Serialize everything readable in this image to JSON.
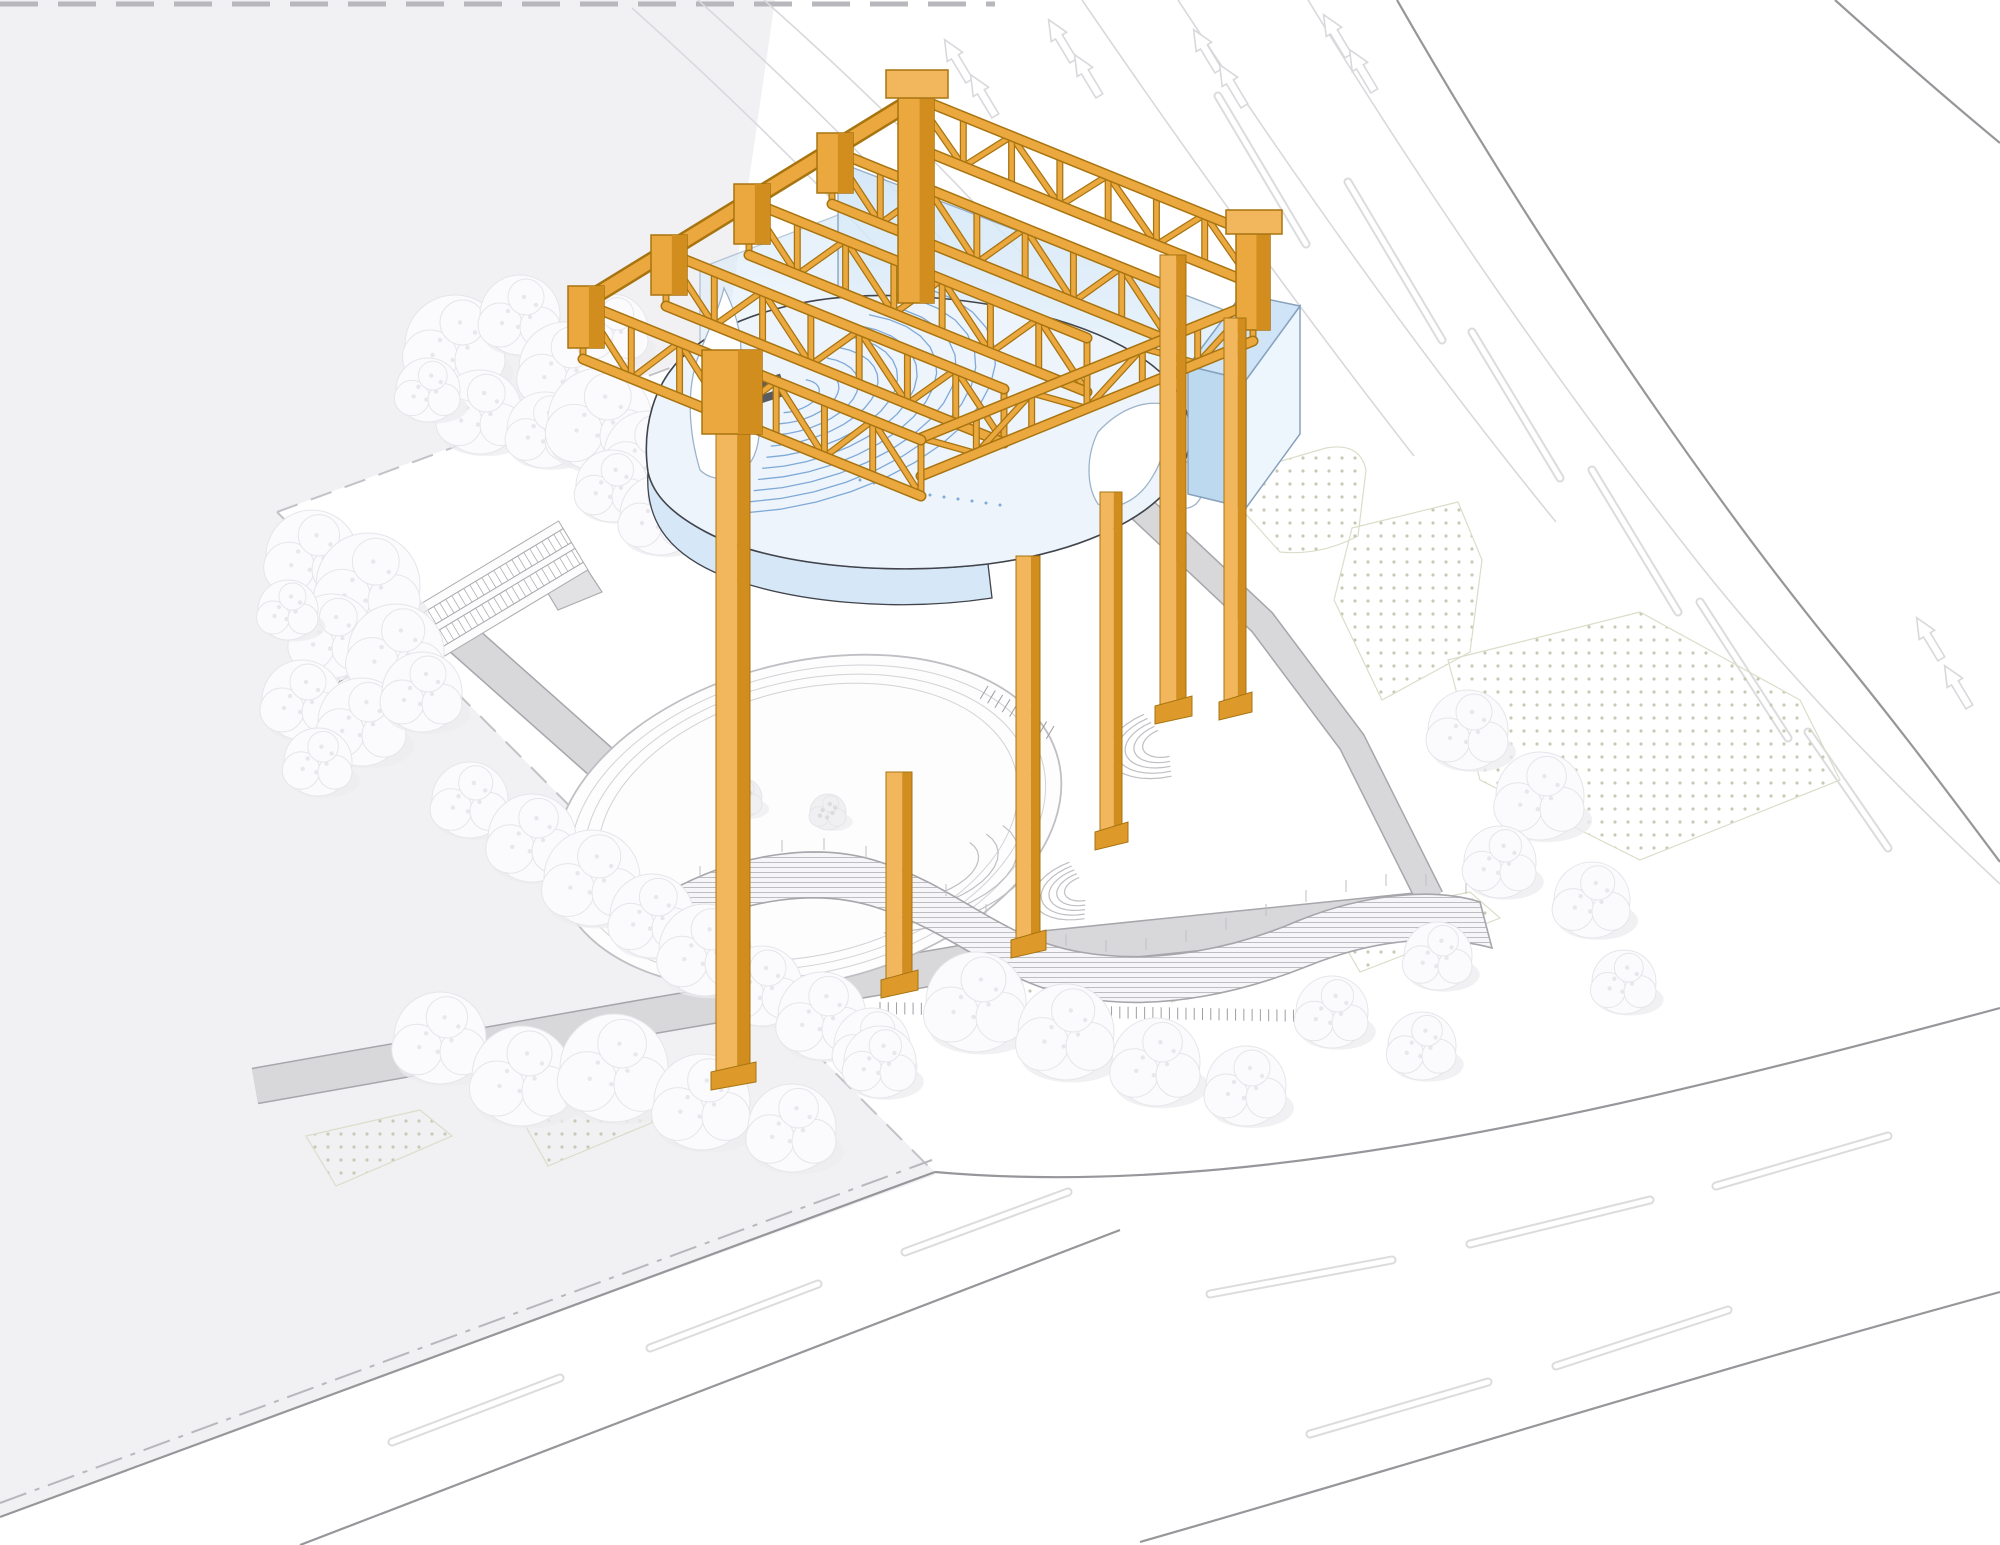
{
  "title": "Axonometric site diagram — orange gantry structure over theater site",
  "palette": {
    "background": "#ffffff",
    "gray_field": "#f1f1f4",
    "road_edge": "#97979b",
    "road_light": "#d9d9dd",
    "lane_outline": "#dcdcdf",
    "lane_core": "#ffffff",
    "boundary_dash": "#c2c2c7",
    "dashdot": "#b7b7bc",
    "path_fill": "#d8d8db",
    "path_edge": "#a6a6ab",
    "dot_fill": "#c9c9b6",
    "dot_edge": "#dcdcca",
    "tree_fill": "#fbfbfd",
    "tree_edge": "#e6e6ea",
    "tree_shadow": "#ececef",
    "tree_speckle": "#e8e8ec",
    "tree_muted": "#f0f0f2",
    "tree_muted_speckle": "#dcdcdf",
    "orange": "#EAA83F",
    "orange_light": "#F2B75C",
    "orange_dark": "#D18D1E",
    "orange_outline": "#A87410",
    "orange_foot": "#DD9A2B",
    "glass_light": "#eef6fd",
    "glass_mid": "#cfe5f7",
    "glass_deep": "#bcd9f0",
    "glass_edge": "#87a2bd",
    "amph_fill": "#edf4fb",
    "amph_line": "#7fa9d8",
    "amph_outline": "#41444b",
    "amph_rim": "#d6e7f7",
    "pylon_fill": "#ffffff",
    "pylon_edge": "#9db3c9",
    "stage_dark": "#5a5b60",
    "court_line": "#bfbfc4",
    "court_line_light": "#d2d2d7",
    "louver_line": "#bdbdc3",
    "louver_bg": "#f6f6f8",
    "hatch": "#9e9ea3",
    "wall_fill": "#e2e2e5",
    "wall_edge": "#ababb0"
  },
  "scene": {
    "grayField": [
      [
        0,
        0
      ],
      [
        775,
        0
      ],
      [
        700,
        520
      ],
      [
        935,
        1175
      ],
      [
        43,
        1500
      ],
      [
        0,
        1517
      ]
    ],
    "siteDiamond": [
      [
        277,
        512
      ],
      [
        727,
        345
      ],
      [
        1300,
        520
      ],
      [
        1240,
        1010
      ],
      [
        935,
        1172
      ]
    ],
    "boundaryDashes": [
      [
        277,
        512,
        727,
        347
      ],
      [
        277,
        512,
        930,
        1168
      ]
    ],
    "topDash": [
      0,
      4,
      995,
      4
    ],
    "dashDot": [
      0,
      1503,
      932,
      1160
    ],
    "roadEdges": [
      "M 0,1517 L 935,1172",
      "M 300,1545 L 1120,1230",
      "M 935,1172 C 1250,1200 1620,1110 2000,1008",
      "M 1140,1542 C 1420,1462 1720,1368 2000,1292",
      "M 1397,0 C 1520,215 1690,470 1832,645 C 1900,728 1952,798 2000,862",
      "M 1835,0 C 1893,52 1948,100 2000,143"
    ],
    "roadLight": [
      "M 1308,0 C 1428,196 1562,390 1700,565 C 1800,690 1902,792 2000,884",
      "M 1178,0 C 1296,180 1424,360 1556,522",
      "M 1082,0 C 1190,158 1300,310 1414,456",
      "M 632,8 C 726,92 820,184 912,284",
      "M 698,0 C 790,82 880,172 968,268",
      "M 764,0 C 852,78 938,162 1020,252"
    ],
    "laneDashes": [
      [
        392,
        1442,
        560,
        1378
      ],
      [
        650,
        1348,
        818,
        1284
      ],
      [
        905,
        1252,
        1068,
        1192
      ],
      [
        1210,
        1294,
        1392,
        1260
      ],
      [
        1470,
        1244,
        1650,
        1200
      ],
      [
        1716,
        1186,
        1888,
        1136
      ],
      [
        1310,
        1434,
        1488,
        1382
      ],
      [
        1556,
        1366,
        1728,
        1310
      ],
      [
        1218,
        96,
        1306,
        244
      ],
      [
        1348,
        182,
        1442,
        340
      ],
      [
        1472,
        332,
        1560,
        478
      ],
      [
        1592,
        470,
        1678,
        612
      ],
      [
        1700,
        602,
        1788,
        738
      ],
      [
        1808,
        732,
        1888,
        848
      ]
    ],
    "arrows": {
      "positions": [
        [
          958,
          62
        ],
        [
          984,
          97
        ],
        [
          1062,
          42
        ],
        [
          1088,
          77
        ],
        [
          1207,
          52
        ],
        [
          1233,
          87
        ],
        [
          1337,
          37
        ],
        [
          1363,
          72
        ],
        [
          1930,
          640
        ],
        [
          1958,
          688
        ]
      ],
      "rotation": -31
    },
    "dotRegions": [
      "M 1250,470 L 1326,448 Q 1360,442 1366,470 L 1358,536 Q 1320,556 1280,552 L 1244,512 Z",
      "M 1352,528 L 1458,502 L 1482,560 L 1470,652 L 1382,700 L 1334,600 Z",
      "M 1448,660 L 1640,612 L 1800,700 L 1840,780 L 1640,860 L 1480,780 Z",
      "M 306,1136 L 420,1110 L 452,1136 L 336,1186 Z",
      "M 520,1116 L 640,1090 L 668,1116 L 548,1166 Z",
      "M 952,978 L 1088,950 L 1126,976 L 990,1036 Z",
      "M 1140,950 L 1286,922 L 1318,948 L 1172,1002 Z",
      "M 1330,920 L 1470,892 L 1500,918 L 1360,972 Z"
    ],
    "walkways": [
      {
        "pts": [
          [
            450,
            628
          ],
          [
            700,
            850
          ],
          [
            746,
            872
          ]
        ],
        "w": 34
      },
      {
        "pts": [
          [
            255,
            1086
          ],
          [
            640,
            1018
          ],
          [
            1050,
            948
          ],
          [
            1442,
            908
          ]
        ],
        "w": 34
      },
      {
        "pts": [
          [
            1128,
            496
          ],
          [
            1262,
            622
          ],
          [
            1352,
            742
          ],
          [
            1430,
            898
          ]
        ],
        "w": 26
      }
    ],
    "landing": [
      [
        706,
        838
      ],
      [
        798,
        870
      ],
      [
        760,
        938
      ],
      [
        668,
        902
      ]
    ],
    "sideWall": [
      [
        528,
        560
      ],
      [
        570,
        543
      ],
      [
        602,
        592
      ],
      [
        558,
        610
      ]
    ],
    "escalator": {
      "x": 573,
      "y": 545,
      "angle": 59,
      "len": 300
    },
    "court": {
      "cx": 808,
      "cy": 822,
      "rx": 258,
      "ry": 160,
      "rot": -14,
      "rings": [
        0,
        -16,
        -30,
        -44
      ]
    },
    "benchArcs": [
      {
        "cx": 1168,
        "cy": 742,
        "r0": 26,
        "step": 9,
        "n": 5,
        "a0": 95,
        "a1": 255,
        "sq": 0.55,
        "rot": -15
      },
      {
        "cx": 1086,
        "cy": 888,
        "r0": 22,
        "step": 8,
        "n": 5,
        "a0": 100,
        "a1": 260,
        "sq": 0.55,
        "rot": -15
      },
      {
        "cx": 920,
        "cy": 868,
        "r0": 60,
        "step": 20,
        "n": 4,
        "a0": -25,
        "a1": 115,
        "sq": 0.5,
        "rot": -14
      }
    ],
    "stairComb": {
      "x1": 988,
      "y1": 686,
      "x2": 1054,
      "y2": 726,
      "n": 9,
      "len": 15
    },
    "louverBuilding": {
      "body": "M 668,892 C 740,852 820,842 880,862 C 960,888 1000,938 1080,952 C 1160,966 1240,946 1300,920 C 1360,896 1430,886 1480,902 L 1492,948 C 1432,932 1368,942 1308,966 C 1248,990 1165,1012 1082,998 C 1000,984 958,934 878,908 C 818,888 742,898 676,936 Z",
      "railTicks": [
        [
          700,
          878
        ],
        [
          740,
          862
        ],
        [
          782,
          852
        ],
        [
          824,
          850
        ],
        [
          866,
          858
        ],
        [
          906,
          874
        ],
        [
          946,
          896
        ],
        [
          986,
          916
        ],
        [
          1026,
          934
        ],
        [
          1066,
          946
        ],
        [
          1106,
          952
        ],
        [
          1146,
          950
        ],
        [
          1186,
          942
        ],
        [
          1226,
          930
        ],
        [
          1266,
          916
        ],
        [
          1306,
          902
        ],
        [
          1346,
          892
        ],
        [
          1386,
          886
        ],
        [
          1426,
          886
        ],
        [
          1466,
          894
        ]
      ],
      "combBase": [
        880,
        1002,
        1310,
        1010
      ],
      "combN": 52
    },
    "trees": [
      [
        455,
        345,
        50
      ],
      [
        520,
        315,
        40
      ],
      [
        565,
        368,
        46
      ],
      [
        612,
        330,
        36
      ],
      [
        480,
        412,
        42
      ],
      [
        545,
        430,
        38
      ],
      [
        428,
        390,
        32
      ],
      [
        600,
        420,
        52
      ],
      [
        648,
        455,
        44
      ],
      [
        612,
        486,
        36
      ],
      [
        660,
        515,
        40
      ],
      [
        690,
        420,
        34
      ],
      [
        312,
        556,
        46
      ],
      [
        368,
        585,
        52
      ],
      [
        332,
        636,
        42
      ],
      [
        396,
        652,
        48
      ],
      [
        302,
        700,
        40
      ],
      [
        362,
        722,
        44
      ],
      [
        422,
        692,
        40
      ],
      [
        318,
        762,
        34
      ],
      [
        288,
        610,
        30
      ],
      [
        470,
        800,
        38
      ],
      [
        532,
        838,
        44
      ],
      [
        592,
        878,
        48
      ],
      [
        652,
        916,
        42
      ],
      [
        705,
        950,
        46
      ],
      [
        762,
        986,
        40
      ],
      [
        822,
        1016,
        44
      ],
      [
        872,
        1046,
        38
      ],
      [
        440,
        1038,
        46
      ],
      [
        522,
        1076,
        50
      ],
      [
        614,
        1068,
        54
      ],
      [
        702,
        1102,
        48
      ],
      [
        792,
        1128,
        44
      ],
      [
        880,
        1062,
        36
      ],
      [
        976,
        1002,
        50
      ],
      [
        1066,
        1032,
        48
      ],
      [
        1156,
        1062,
        44
      ],
      [
        1246,
        1086,
        40
      ],
      [
        1332,
        1012,
        36
      ],
      [
        1422,
        1046,
        34
      ],
      [
        1468,
        730,
        40
      ],
      [
        1540,
        796,
        44
      ],
      [
        1500,
        862,
        36
      ],
      [
        1592,
        900,
        38
      ],
      [
        1624,
        982,
        32
      ],
      [
        1438,
        956,
        34
      ]
    ],
    "mutedTrees": [
      [
        742,
        798,
        20
      ],
      [
        828,
        812,
        18
      ]
    ],
    "glassPanes": [
      {
        "pts": [
          [
            838,
            162
          ],
          [
            1245,
            318
          ],
          [
            1245,
            442
          ],
          [
            838,
            306
          ]
        ],
        "op": 0.85
      },
      {
        "pts": [
          [
            700,
            268
          ],
          [
            838,
            215
          ],
          [
            838,
            330
          ],
          [
            700,
            382
          ]
        ],
        "op": 0.55
      }
    ],
    "glassBox": {
      "top": [
        [
          1188,
          366
        ],
        [
          1242,
          294
        ],
        [
          1300,
          306
        ],
        [
          1246,
          380
        ]
      ],
      "front": [
        [
          1188,
          366
        ],
        [
          1246,
          380
        ],
        [
          1246,
          508
        ],
        [
          1188,
          494
        ]
      ],
      "right": [
        [
          1246,
          380
        ],
        [
          1300,
          306
        ],
        [
          1300,
          434
        ],
        [
          1246,
          508
        ]
      ]
    },
    "amph": {
      "disc": "M 648,472 C 642,430 652,382 688,352 C 735,312 818,292 905,296 C 1000,300 1090,322 1145,360 C 1188,390 1200,430 1182,468 C 1158,518 1080,552 988,564 C 890,576 770,566 706,532 C 672,514 653,495 648,472 Z",
      "rim": "M 648,472 C 653,495 672,514 706,532 C 770,566 890,576 988,564 L 992,598 C 900,612 788,604 714,572 C 666,550 645,518 648,472 Z",
      "seat": {
        "cx": 790,
        "cy": 396,
        "r0": 30,
        "step": 20,
        "n": 10,
        "a0": -50,
        "a1": 115,
        "kx": 1.15,
        "ky": 0.52,
        "rot": -14
      },
      "pylons": [
        "M 700,470 C 688,430 686,386 700,352 C 710,326 720,306 724,288 C 734,308 744,336 740,364 C 756,396 766,428 754,456 C 744,478 716,486 700,470 Z",
        "M 1098,432 C 1120,408 1148,398 1170,406 C 1162,428 1168,452 1154,474 C 1140,500 1116,512 1098,504 C 1086,486 1086,456 1098,432 Z",
        "M 1176,470 C 1188,458 1202,456 1210,464 C 1204,480 1206,494 1196,504 C 1186,512 1174,508 1172,496 C 1170,486 1170,478 1176,470 Z"
      ],
      "stageRects": [
        [
          742,
          386,
          40,
          10,
          -18
        ],
        [
          752,
          398,
          34,
          8,
          -18
        ]
      ],
      "floorDots": [
        [
          860,
          480
        ],
        [
          874,
          483
        ],
        [
          888,
          486
        ],
        [
          902,
          489
        ],
        [
          916,
          492
        ],
        [
          930,
          495
        ],
        [
          944,
          497
        ],
        [
          958,
          499
        ],
        [
          972,
          501
        ],
        [
          986,
          503
        ],
        [
          1000,
          505
        ]
      ]
    },
    "trusses": [
      {
        "p": [
          832,
          150,
          1170,
          287
        ],
        "h": 54,
        "n": 7
      },
      {
        "p": [
          749,
          201,
          1087,
          338
        ],
        "h": 54,
        "n": 7
      },
      {
        "p": [
          666,
          252,
          1004,
          389
        ],
        "h": 54,
        "n": 7
      },
      {
        "p": [
          915,
          97,
          1253,
          234
        ],
        "h": 50,
        "n": 7
      },
      {
        "p": [
          921,
          438,
          1253,
          303
        ],
        "h": 38,
        "n": 6
      },
      {
        "p": [
          583,
          303,
          921,
          440
        ],
        "h": 56,
        "n": 7
      }
    ],
    "stepBand": [
      [
        583,
        303
      ],
      [
        666,
        252
      ],
      [
        749,
        201
      ],
      [
        832,
        150
      ],
      [
        915,
        99
      ]
    ],
    "capBlocks": [
      [
        568,
        286,
        36,
        62
      ],
      [
        651,
        235,
        36,
        60
      ],
      [
        734,
        184,
        36,
        60
      ],
      [
        817,
        133,
        36,
        60
      ]
    ],
    "posts": [
      {
        "body": [
          898,
          85,
          36,
          218
        ],
        "cap": [
          886,
          70,
          62,
          28
        ]
      },
      {
        "body": [
          1236,
          222,
          34,
          108
        ],
        "cap": [
          1226,
          210,
          56,
          24
        ]
      }
    ],
    "legs": [
      {
        "x": 716,
        "w": 34,
        "y0": 428,
        "y1": 1078,
        "block": [
          702,
          350,
          60,
          84
        ]
      },
      {
        "x": 886,
        "w": 26,
        "y0": 772,
        "y1": 986
      },
      {
        "x": 1016,
        "w": 24,
        "y0": 556,
        "y1": 946
      },
      {
        "x": 1100,
        "w": 22,
        "y0": 492,
        "y1": 838
      },
      {
        "x": 1160,
        "w": 26,
        "y0": 255,
        "y1": 712
      },
      {
        "x": 1224,
        "w": 22,
        "y0": 318,
        "y1": 708
      }
    ]
  }
}
